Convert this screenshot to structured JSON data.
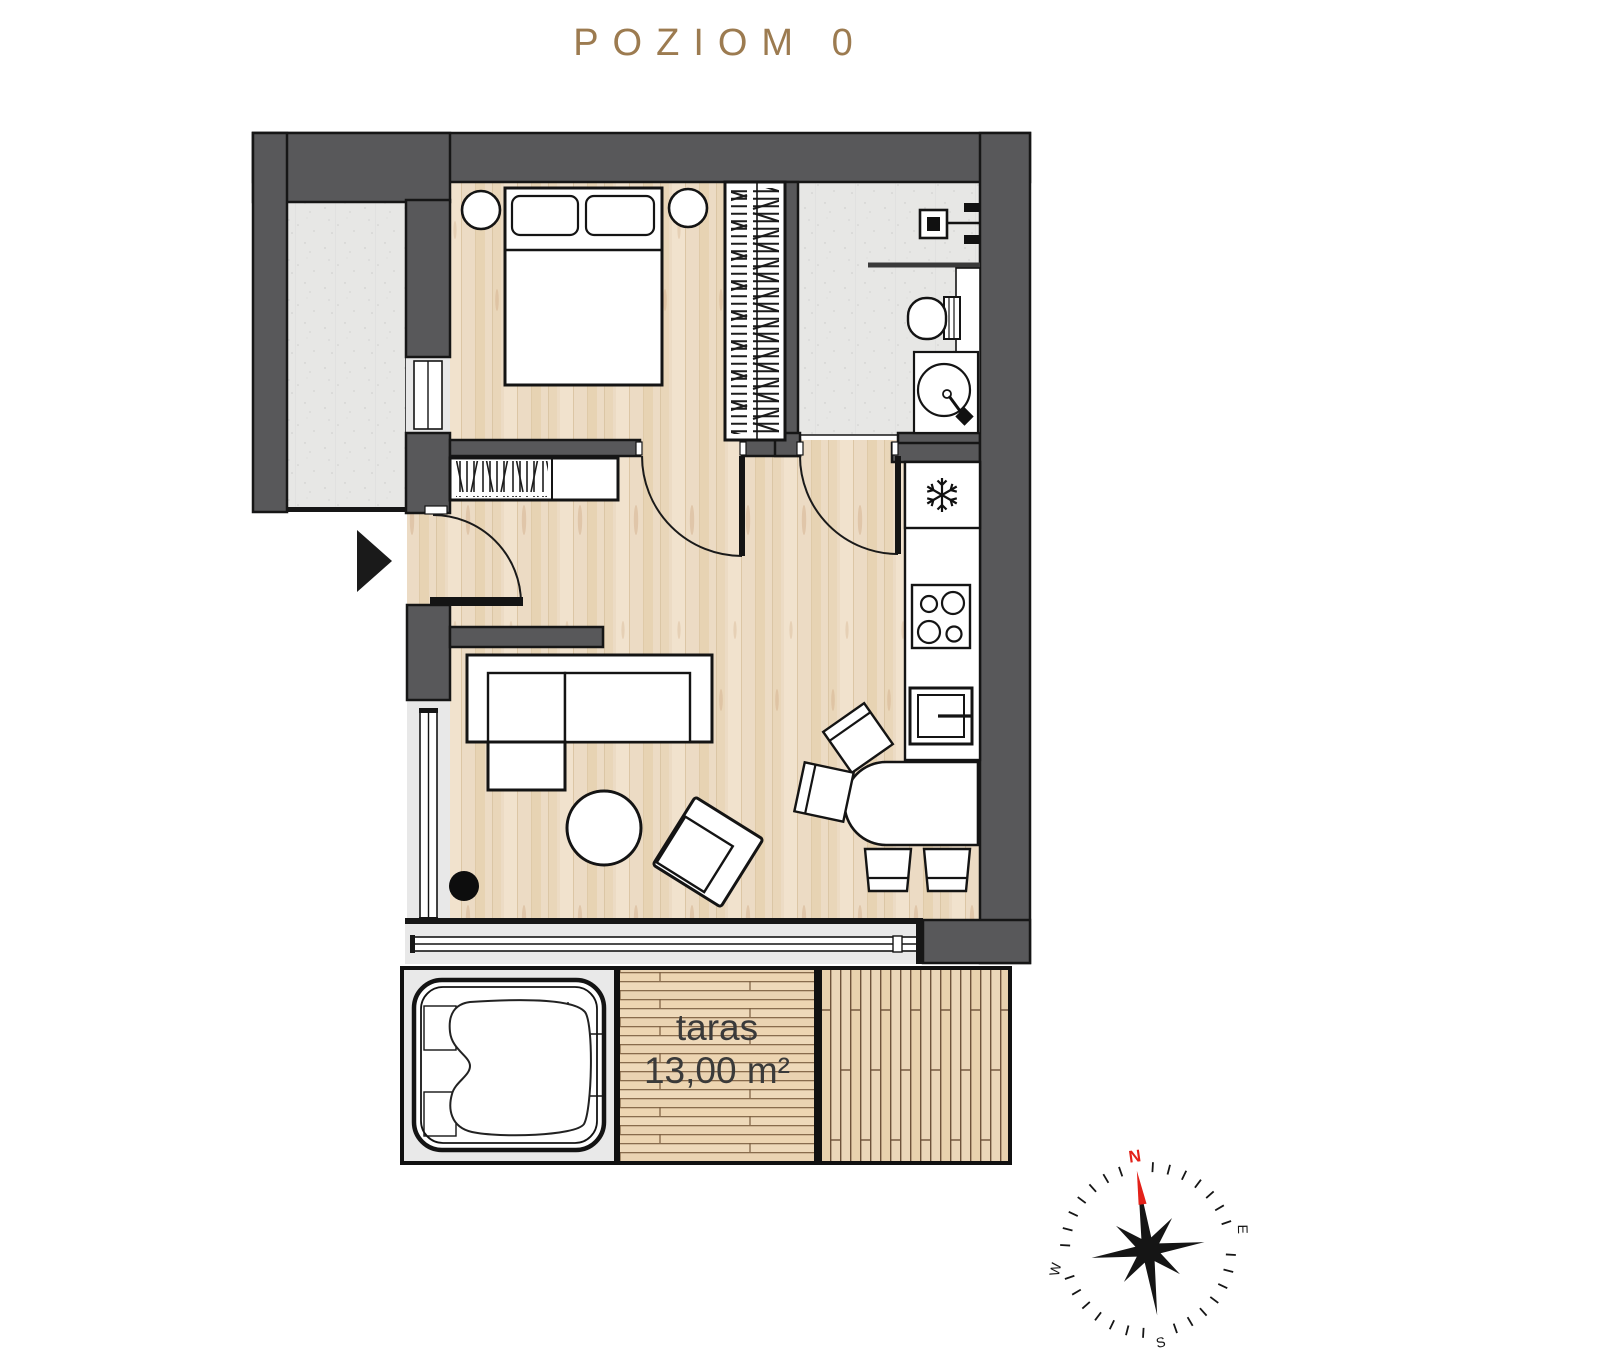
{
  "title": "POZIOM 0",
  "floor_plan": {
    "terrace": {
      "label": "taras",
      "area": "13,00 m²"
    },
    "compass": {
      "north": "N",
      "east": "E",
      "south": "S",
      "west": "W"
    }
  },
  "colors": {
    "wall": "#58585a",
    "outline": "#161616",
    "title_text": "#9c7b50",
    "wood_floor": "#ecdbc4",
    "deck_wood": "#eed9ba",
    "concrete": "#e7e7e5",
    "window_gray": "#e8e8e8",
    "terrace_text": "#3a3a3a",
    "compass_north": "#e32119"
  }
}
